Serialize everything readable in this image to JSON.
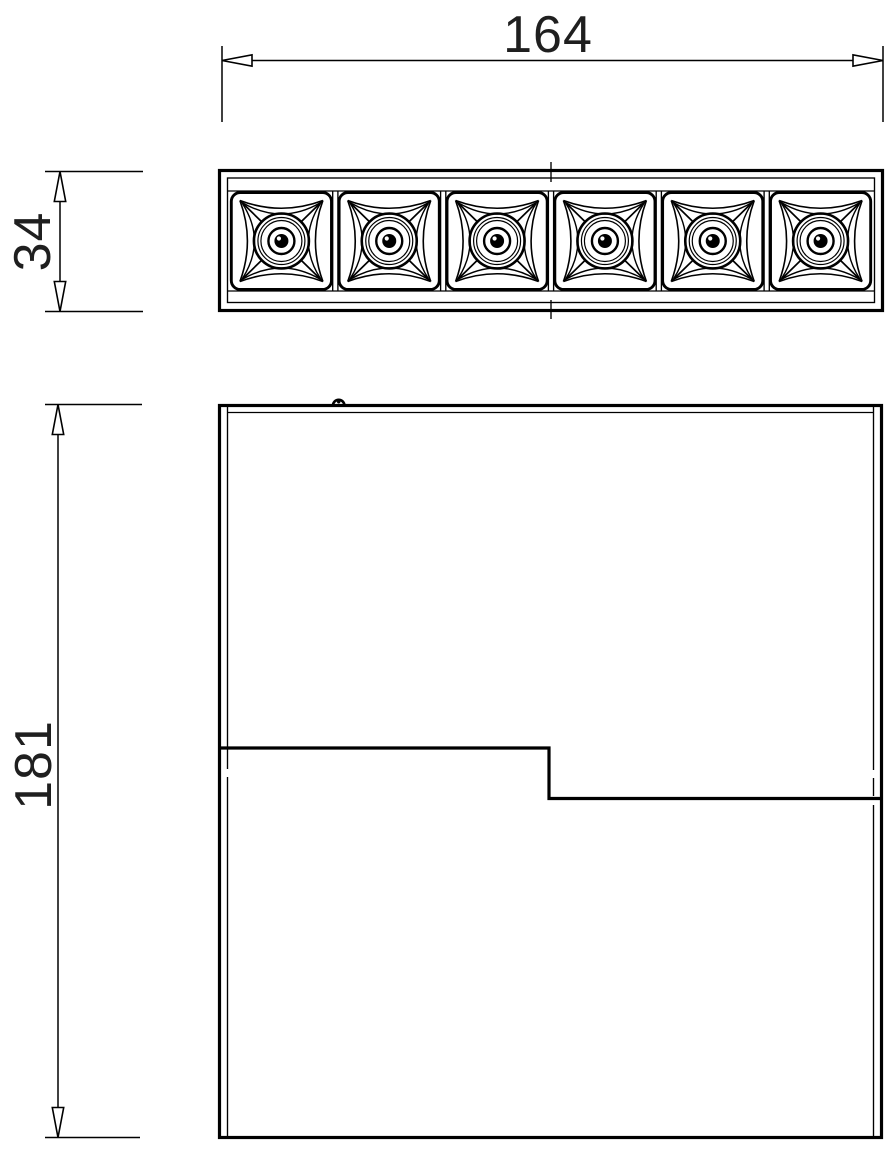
{
  "page": {
    "background_color": "#ffffff",
    "line_color": "#000000",
    "text_color": "#1f1f1f"
  },
  "drawing": {
    "type": "technical-dimension-drawing",
    "dimensions": {
      "overall_width": {
        "label": "164",
        "orientation": "horizontal",
        "applies_to": "top-view-module-width"
      },
      "module_height": {
        "label": "34",
        "orientation": "vertical",
        "applies_to": "top-view-module-height"
      },
      "housing_height": {
        "label": "181",
        "orientation": "vertical",
        "applies_to": "front-view-housing-height"
      }
    },
    "top_view": {
      "led_cell_count": 6
    },
    "front_view": {
      "has_stepped_parting_line": true,
      "has_mounting_tab": true
    }
  }
}
